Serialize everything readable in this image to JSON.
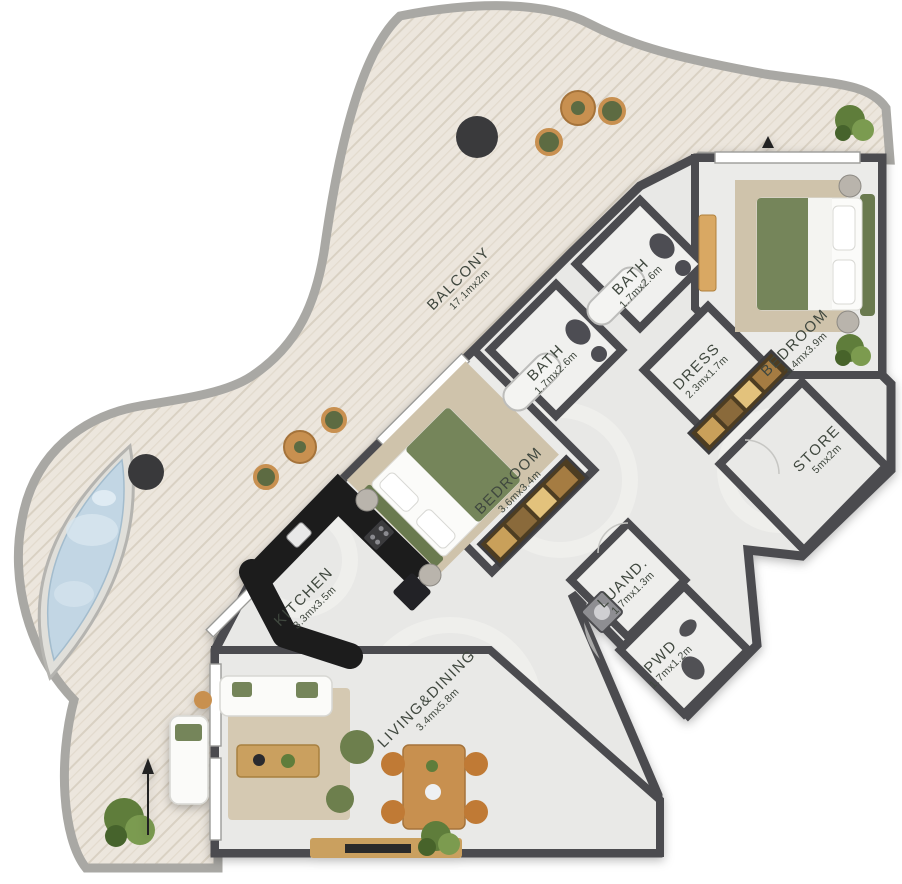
{
  "plan": {
    "type": "apartment-floor-plan",
    "rooms": [
      {
        "name": "BALCONY",
        "dims": "17.1mx2m"
      },
      {
        "name": "BATH",
        "dims": "1.7mx2.6m"
      },
      {
        "name": "BATH",
        "dims": "1.7mx2.6m"
      },
      {
        "name": "BEDROOM",
        "dims": "3.4mx3.9m"
      },
      {
        "name": "DRESS",
        "dims": "2.3mx1.7m"
      },
      {
        "name": "STORE",
        "dims": "5mx2m"
      },
      {
        "name": "BEDROOM",
        "dims": "3.6mx3.4m"
      },
      {
        "name": "KITCHEN",
        "dims": "3.3mx3.5m"
      },
      {
        "name": "LUAND.",
        "dims": "1.7mx1.3m"
      },
      {
        "name": "PWD",
        "dims": "1.7mx1.2m"
      },
      {
        "name": "LIVING&DINING",
        "dims": "3.4mx5.8m"
      }
    ],
    "colors": {
      "wall": "#4c4c50",
      "balcony_wood": "#ece6dd",
      "pool_water": "#c2d6e4",
      "floor": "#e8e8e6",
      "greenery": "#6f8443",
      "wood_furniture": "#cfa05c",
      "accent_green": "#74855a"
    }
  }
}
